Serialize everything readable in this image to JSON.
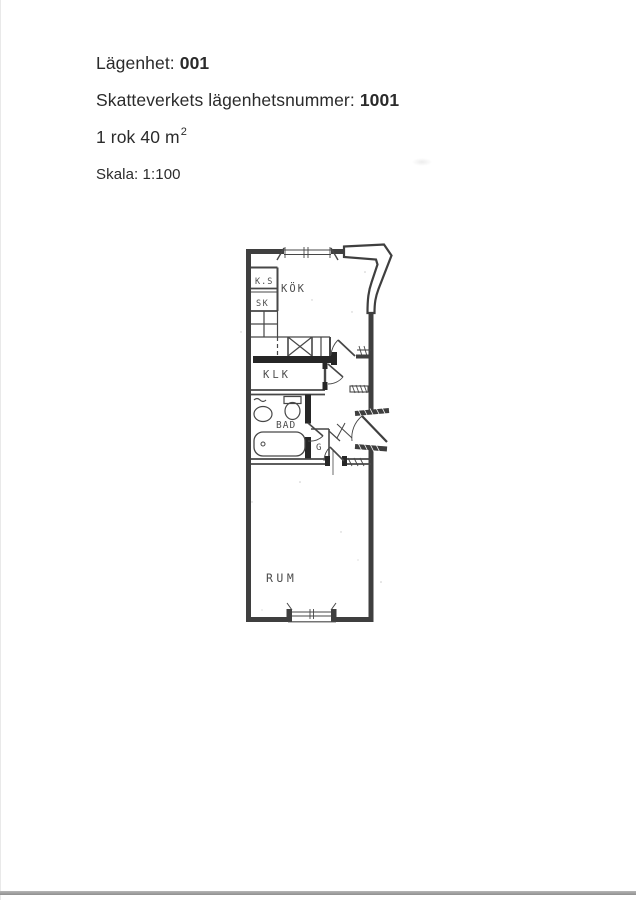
{
  "header": {
    "line1_label": "Lägenhet:",
    "line1_value": "001",
    "line2_label": "Skatteverkets lägenhetsnummer:",
    "line2_value": "1001",
    "line3_text": "1 rok 40 m",
    "line3_superscript": "2",
    "line4_text": "Skala: 1:100"
  },
  "plan": {
    "ink_color": "#3f3f3f",
    "paper_color": "#ffffff",
    "rooms": [
      {
        "id": "ks",
        "label": "K.S"
      },
      {
        "id": "sk",
        "label": "SK"
      },
      {
        "id": "kok",
        "label": "KÖK"
      },
      {
        "id": "klk",
        "label": "KLK"
      },
      {
        "id": "bad",
        "label": "BAD"
      },
      {
        "id": "g",
        "label": "G"
      },
      {
        "id": "rum",
        "label": "RUM"
      }
    ]
  }
}
